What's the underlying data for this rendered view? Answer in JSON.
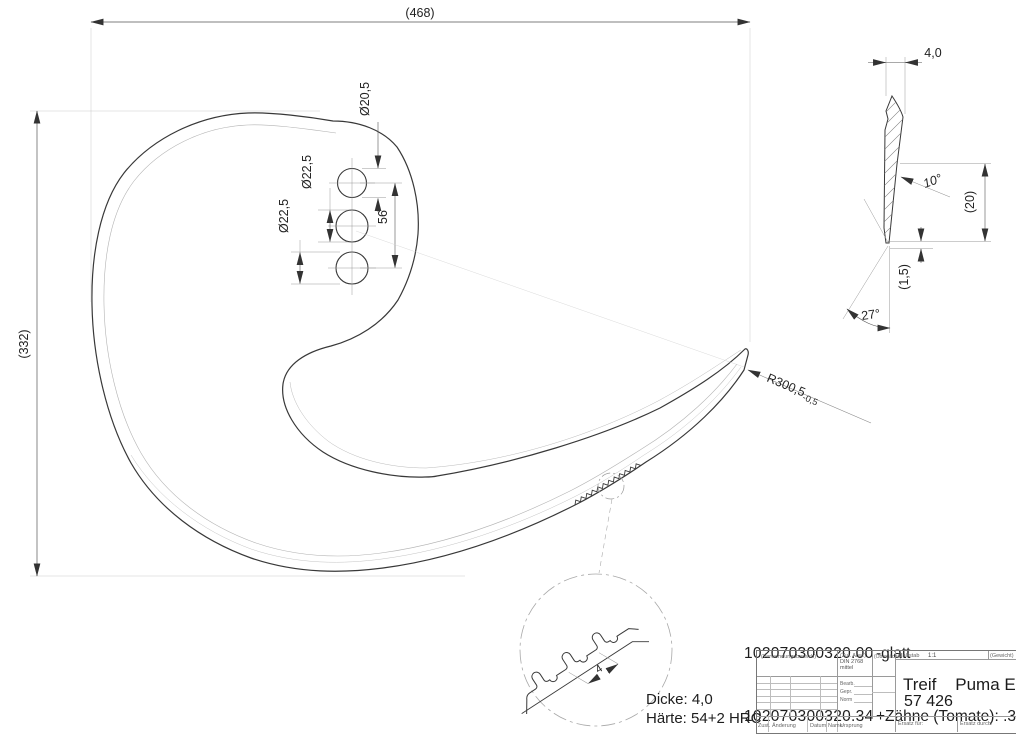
{
  "drawing": {
    "dims": {
      "overall_width": "(468)",
      "overall_height": "(332)",
      "hole_top_dia": "Ø20,5",
      "hole_mid_dia": "Ø22,5",
      "hole_bot_dia": "Ø22,5",
      "hole_spacing": "56",
      "edge_radius": "R300,5",
      "edge_radius_tol": "-0,5",
      "thickness": "4,0",
      "bevel_angle": "10°",
      "section_height": "(20)",
      "edge_land": "(1,5)",
      "tip_angle": "27°",
      "tooth_pitch": "4"
    },
    "parts": [
      {
        "number": "102070300320.00",
        "variant": "-glatt"
      },
      {
        "number": "102070300320.34",
        "variant": "+Zähne (Tomate): .34"
      }
    ],
    "notes": {
      "thickness": "Dicke: 4,0",
      "hardness": "Härte: 54+2 HRC"
    },
    "title_block": {
      "usage_label": "(Verwendungsbereich)",
      "tolerance_label": "(Zul. Abw.)",
      "tolerance_value_line1": "DIN 2768",
      "tolerance_value_line2": "mittel",
      "surface_label": "(Oberfläche)",
      "scale_label": "Maßstab",
      "scale_value": "1:1",
      "weight_label": "(Gewicht)",
      "bearb_label": "Bearb.",
      "gepr_label": "Gepr.",
      "norm_label": "Norm",
      "product_title": "Treif    Puma E",
      "drawing_number": "57 426",
      "rev_state_label": "Zust.",
      "rev_change_label": "Änderung",
      "rev_date_label": "Datum",
      "rev_name_label": "Name",
      "origin_label": "Ursprung",
      "replacement_for_label": "Ersatz für:",
      "replaced_by_label": "Ersatz durch:"
    }
  }
}
